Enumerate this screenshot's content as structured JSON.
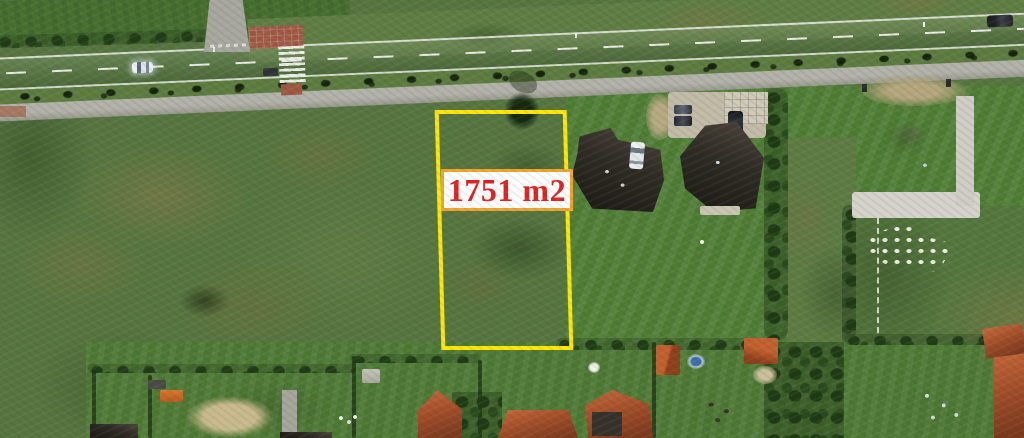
{
  "annotation": {
    "area_label": "1751 m2"
  },
  "scene_features": [
    "vacant-plot-outline",
    "asphalt-road",
    "bike-path",
    "pedestrian-crossing",
    "side-road",
    "roadside-bushes",
    "dark-roof-houses",
    "red-roof-houses",
    "parked-cars",
    "lawns",
    "rough-grassland",
    "garden-sheds",
    "paver-stacks",
    "pool"
  ],
  "colors": {
    "plot-outline": "#ffe609",
    "label-text": "#e12222",
    "label-bg": "#ffffff",
    "label-border": "#f1a42e",
    "grass-base": "#567540",
    "lawn": "#4e7c34",
    "verge": "#5d7c40",
    "road": "#92928e",
    "path": "#a9a9a1",
    "roof-dark": "#2e2a24",
    "roof-red": "#a34e2a",
    "hedge": "#24421c",
    "sand": "#c9ba8e",
    "paving-red": "#a05844",
    "parking": "#c3bba8"
  }
}
